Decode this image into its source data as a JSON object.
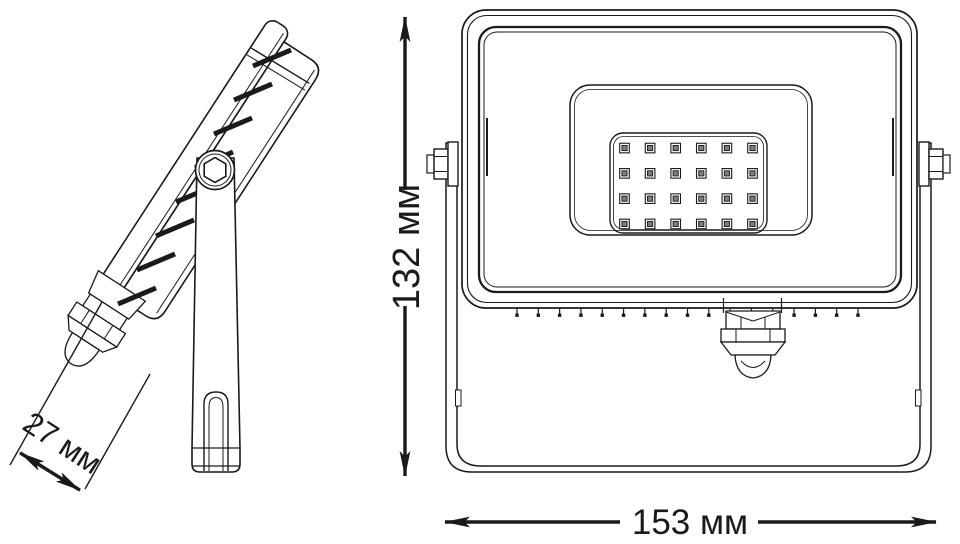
{
  "drawing": {
    "product": "LED floodlight two-view technical drawing",
    "dimensions": {
      "depth": {
        "value": "27",
        "unit": "мм",
        "label": "27 мм"
      },
      "height": {
        "value": "132",
        "unit": "мм",
        "label": "132 мм"
      },
      "width": {
        "value": "153",
        "unit": "мм",
        "label": "153 мм"
      }
    },
    "led_grid": {
      "rows": 4,
      "columns": 6,
      "total_leds": 24
    },
    "vent_ticks": {
      "count": 17
    },
    "colors": {
      "line": "#1a1a1a",
      "background": "#ffffff",
      "led_fill": "#7d7d7d"
    }
  }
}
